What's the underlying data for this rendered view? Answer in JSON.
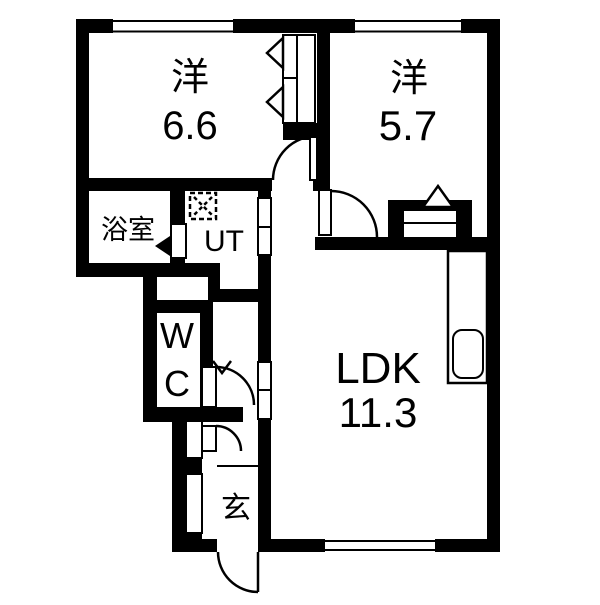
{
  "title": "apartment-floor-plan",
  "colors": {
    "wall": "#000000",
    "background": "#ffffff",
    "line": "#000000"
  },
  "rooms": {
    "bedroom1": {
      "label": "洋",
      "area": "6.6"
    },
    "bedroom2": {
      "label": "洋",
      "area": "5.7"
    },
    "bathroom": {
      "label": "浴室"
    },
    "utility": {
      "label": "UT"
    },
    "wc": {
      "line1": "W",
      "line2": "C"
    },
    "ldk": {
      "label": "LDK",
      "area": "11.3"
    },
    "entrance": {
      "label": "玄"
    }
  },
  "symbols": {
    "washing_machine": "dashed-square-with-x",
    "closet_folding_door": "outlined-triangle",
    "door": "quarter-arc-swing",
    "window": "white-band-in-wall"
  }
}
